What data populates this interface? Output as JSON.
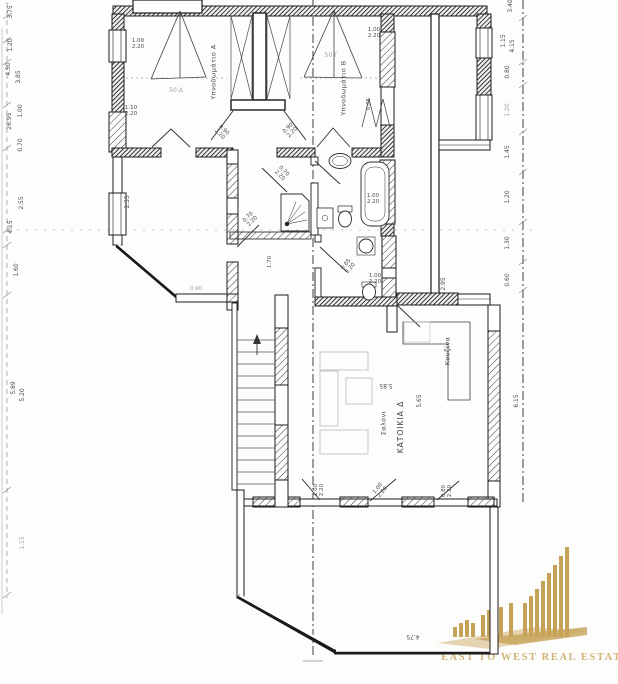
{
  "document": {
    "kind": "scanned architectural floor plan",
    "background": "#fdfdfc",
    "ink_color": "#1b1b1b"
  },
  "logo": {
    "text": "EAST TO WEST REAL ESTATE",
    "color": "#c5a258",
    "icon": "city-skyline-bars"
  },
  "labels": [
    {
      "t": "Υπνοδωμάτιο Α",
      "x": 214,
      "y": 72,
      "r": -90,
      "s": 6.5,
      "cls": "room"
    },
    {
      "t": "Υπνοδωμάτιο Β",
      "x": 344,
      "y": 88,
      "r": -90,
      "s": 6.5,
      "cls": "room"
    },
    {
      "t": "ΚΑΤΟΙΚΙΑ Δ",
      "x": 401,
      "y": 427,
      "r": -90,
      "s": 7.5,
      "cls": "room big"
    },
    {
      "t": "Σαλόνι",
      "x": 384,
      "y": 423,
      "r": -90,
      "s": 6.5,
      "cls": "room"
    },
    {
      "t": "Κουζίνα",
      "x": 448,
      "y": 351,
      "r": -90,
      "s": 6.5,
      "cls": "room"
    },
    {
      "t": "50 Δ",
      "x": 176,
      "y": 91,
      "r": 0,
      "s": 6,
      "cls": "faint"
    },
    {
      "t": "50 Γ",
      "x": 331,
      "y": 56,
      "r": 0,
      "s": 6,
      "cls": "faint"
    },
    {
      "t": "1.00\n2.20",
      "x": 138,
      "y": 45,
      "r": 0,
      "s": 5.5,
      "cls": "dim"
    },
    {
      "t": "1.10\n2.20",
      "x": 131,
      "y": 112,
      "r": 0,
      "s": 5.5,
      "cls": "dim"
    },
    {
      "t": "0.90\n2.20",
      "x": 221,
      "y": 133,
      "r": 45,
      "s": 5.5,
      "cls": "dim"
    },
    {
      "t": "0.90\n2.20",
      "x": 291,
      "y": 131,
      "r": -45,
      "s": 5.5,
      "cls": "dim"
    },
    {
      "t": "1.00\n2.20",
      "x": 374,
      "y": 34,
      "r": 0,
      "s": 5.5,
      "cls": "dim"
    },
    {
      "t": "0.85",
      "x": 370,
      "y": 104,
      "r": -90,
      "s": 5.5,
      "cls": "dim"
    },
    {
      "t": "0.70\n2.20",
      "x": 281,
      "y": 174,
      "r": 45,
      "s": 5.5,
      "cls": "dim"
    },
    {
      "t": "0.70\n2.20",
      "x": 251,
      "y": 220,
      "r": -45,
      "s": 5.5,
      "cls": "dim"
    },
    {
      "t": "1.00\n2.20",
      "x": 373,
      "y": 200,
      "r": 0,
      "s": 5.5,
      "cls": "dim"
    },
    {
      "t": "0.65\n2.20",
      "x": 349,
      "y": 267,
      "r": -50,
      "s": 5.5,
      "cls": "dim"
    },
    {
      "t": "1.00\n2.20",
      "x": 375,
      "y": 280,
      "r": 0,
      "s": 5.5,
      "cls": "dim"
    },
    {
      "t": "2.95",
      "x": 444,
      "y": 284,
      "r": -90,
      "s": 6,
      "cls": "dim"
    },
    {
      "t": "1.70",
      "x": 271,
      "y": 262,
      "r": -90,
      "s": 5.5,
      "cls": "dim"
    },
    {
      "t": "0.90",
      "x": 196,
      "y": 290,
      "r": 0,
      "s": 5.5,
      "cls": "faint"
    },
    {
      "t": "2.55",
      "x": 128,
      "y": 202,
      "r": -90,
      "s": 6,
      "cls": "dim"
    },
    {
      "t": "5.85",
      "x": 386,
      "y": 385,
      "r": 180,
      "s": 6,
      "cls": "dim"
    },
    {
      "t": "5.65",
      "x": 420,
      "y": 401,
      "r": -90,
      "s": 6,
      "cls": "dim"
    },
    {
      "t": "1.00\n2.20",
      "x": 320,
      "y": 490,
      "r": -90,
      "s": 5.5,
      "cls": "dim"
    },
    {
      "t": "1.00\n2.20",
      "x": 381,
      "y": 491,
      "r": -52,
      "s": 5.5,
      "cls": "dim"
    },
    {
      "t": "0.80\n2.20",
      "x": 448,
      "y": 491,
      "r": -90,
      "s": 5.5,
      "cls": "dim"
    },
    {
      "t": "4.75",
      "x": 413,
      "y": 636,
      "r": 180,
      "s": 6,
      "cls": "dim"
    },
    {
      "t": "3.75",
      "x": 11,
      "y": 12,
      "r": -90,
      "s": 6,
      "cls": "dim"
    },
    {
      "t": "1.20",
      "x": 11,
      "y": 45,
      "r": -90,
      "s": 6,
      "cls": "dim"
    },
    {
      "t": "4.50",
      "x": 9,
      "y": 69,
      "r": -90,
      "s": 6,
      "cls": "dim"
    },
    {
      "t": "3.85",
      "x": 19,
      "y": 77,
      "r": -90,
      "s": 6,
      "cls": "dim"
    },
    {
      "t": "1.00",
      "x": 21,
      "y": 111,
      "r": -90,
      "s": 6,
      "cls": "dim"
    },
    {
      "t": "26.95",
      "x": 10,
      "y": 121,
      "r": -90,
      "s": 6,
      "cls": "dim"
    },
    {
      "t": "0.70",
      "x": 21,
      "y": 145,
      "r": -90,
      "s": 6,
      "cls": "dim"
    },
    {
      "t": "2.55",
      "x": 22,
      "y": 203,
      "r": -90,
      "s": 6,
      "cls": "dim"
    },
    {
      "t": "4.15",
      "x": 11,
      "y": 227,
      "r": -90,
      "s": 6,
      "cls": "dim"
    },
    {
      "t": "1.60",
      "x": 17,
      "y": 270,
      "r": -90,
      "s": 6,
      "cls": "dim"
    },
    {
      "t": "5.89",
      "x": 14,
      "y": 388,
      "r": -90,
      "s": 6,
      "cls": "dim"
    },
    {
      "t": "5.20",
      "x": 23,
      "y": 395,
      "r": -90,
      "s": 6,
      "cls": "dim"
    },
    {
      "t": "1.15",
      "x": 23,
      "y": 543,
      "r": -90,
      "s": 6,
      "cls": "faint"
    },
    {
      "t": "3.40",
      "x": 511,
      "y": 6,
      "r": -90,
      "s": 6,
      "cls": "dim"
    },
    {
      "t": "1.15",
      "x": 504,
      "y": 41,
      "r": -90,
      "s": 6,
      "cls": "dim"
    },
    {
      "t": "4.15",
      "x": 513,
      "y": 46,
      "r": -90,
      "s": 6,
      "cls": "dim"
    },
    {
      "t": "0.80",
      "x": 508,
      "y": 72,
      "r": -90,
      "s": 6,
      "cls": "dim"
    },
    {
      "t": "1.20",
      "x": 508,
      "y": 110,
      "r": -90,
      "s": 6,
      "cls": "faint"
    },
    {
      "t": "1.45",
      "x": 508,
      "y": 152,
      "r": -90,
      "s": 6,
      "cls": "dim"
    },
    {
      "t": "1.20",
      "x": 508,
      "y": 197,
      "r": -90,
      "s": 6,
      "cls": "dim"
    },
    {
      "t": "1.30",
      "x": 508,
      "y": 243,
      "r": -90,
      "s": 6,
      "cls": "dim"
    },
    {
      "t": "0.60",
      "x": 508,
      "y": 280,
      "r": -90,
      "s": 6,
      "cls": "dim"
    },
    {
      "t": "6.15",
      "x": 517,
      "y": 401,
      "r": -90,
      "s": 6,
      "cls": "dim"
    }
  ]
}
